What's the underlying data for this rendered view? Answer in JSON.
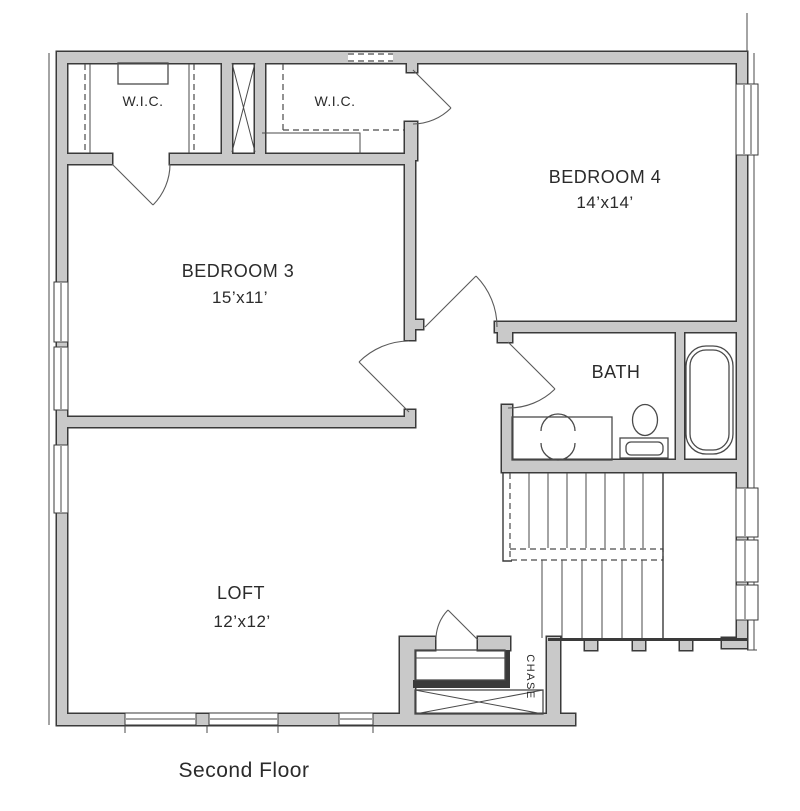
{
  "plan": {
    "title": "Second Floor",
    "rooms": {
      "wic1": {
        "label": "W.I.C."
      },
      "wic2": {
        "label": "W.I.C."
      },
      "bedroom4": {
        "label": "BEDROOM 4",
        "dims": "14’x14’"
      },
      "bedroom3": {
        "label": "BEDROOM 3",
        "dims": "15’x11’"
      },
      "bath": {
        "label": "BATH"
      },
      "loft": {
        "label": "LOFT",
        "dims": "12’x12’"
      },
      "chase": {
        "label": "CHASE"
      }
    },
    "colors": {
      "wall_fill": "#c9c9c9",
      "wall_outline": "#3a3a3a",
      "line": "#4a4a4a",
      "text": "#2b2b2b",
      "background": "#ffffff"
    }
  }
}
